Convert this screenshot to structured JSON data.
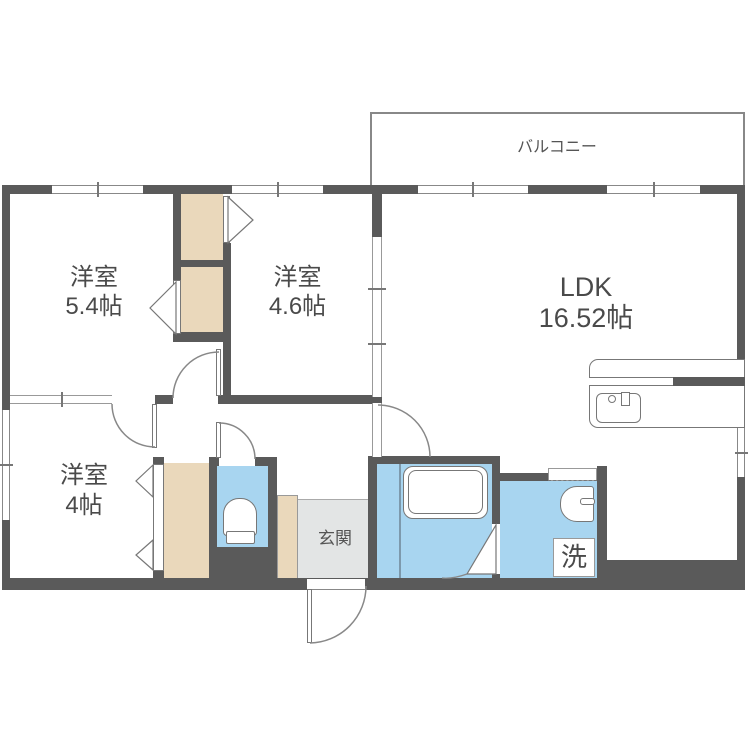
{
  "floorplan": {
    "balcony": {
      "label": "バルコニー"
    },
    "bedroom1": {
      "name": "洋室",
      "size": "5.4帖"
    },
    "bedroom2": {
      "name": "洋室",
      "size": "4.6帖"
    },
    "bedroom3": {
      "name": "洋室",
      "size": "4帖"
    },
    "ldk": {
      "name": "LDK",
      "size": "16.52帖"
    },
    "entrance": {
      "label": "玄関"
    },
    "laundry": {
      "label": "洗"
    },
    "colors": {
      "wall": "#5a5a5a",
      "closet": "#ead8bb",
      "water_area": "#a8d5f0",
      "entrance_floor": "#e3e5e5",
      "line": "#888888",
      "text": "#4a4a4a",
      "background": "#ffffff"
    }
  }
}
